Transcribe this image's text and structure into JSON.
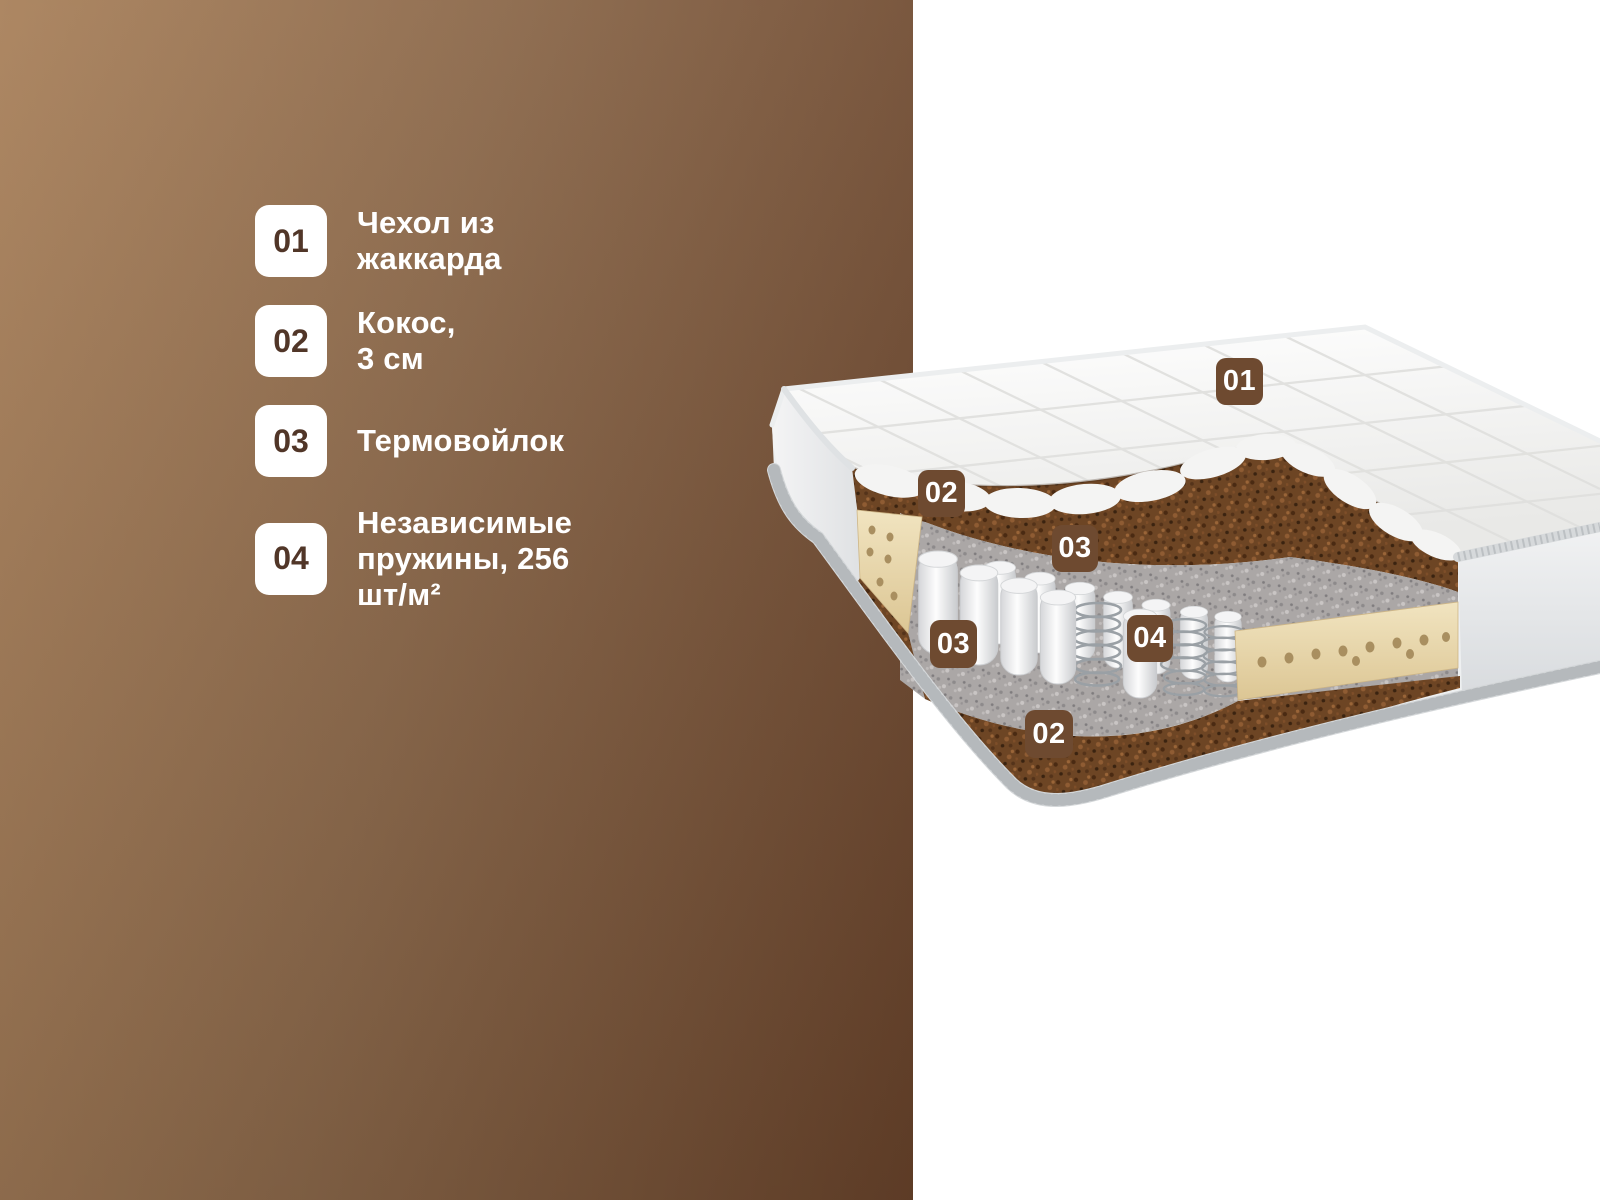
{
  "colors": {
    "panel_brown_light": "#a9815b",
    "panel_brown_dark": "#67422a",
    "label_badge_brown": "#6e4a30",
    "legend_number_brown": "#513628",
    "text_white": "#ffffff",
    "coconut_layer": "#6d4524",
    "felt_layer": "#aba7a6",
    "foam_rail_cream": "#ead9ab"
  },
  "legend": {
    "items": [
      {
        "number": "01",
        "label": "Чехол из жаккарда"
      },
      {
        "number": "02",
        "label": "Кокос, 3 см"
      },
      {
        "number": "03",
        "label": "Термовойлок"
      },
      {
        "number": "04",
        "label": "Независимые пружины, 256 шт/м²"
      }
    ]
  },
  "mattress_labels": {
    "cover": "01",
    "coconut_top": "02",
    "felt_top": "03",
    "springs": "04",
    "felt_bottom": "03",
    "coconut_bottom": "02"
  }
}
